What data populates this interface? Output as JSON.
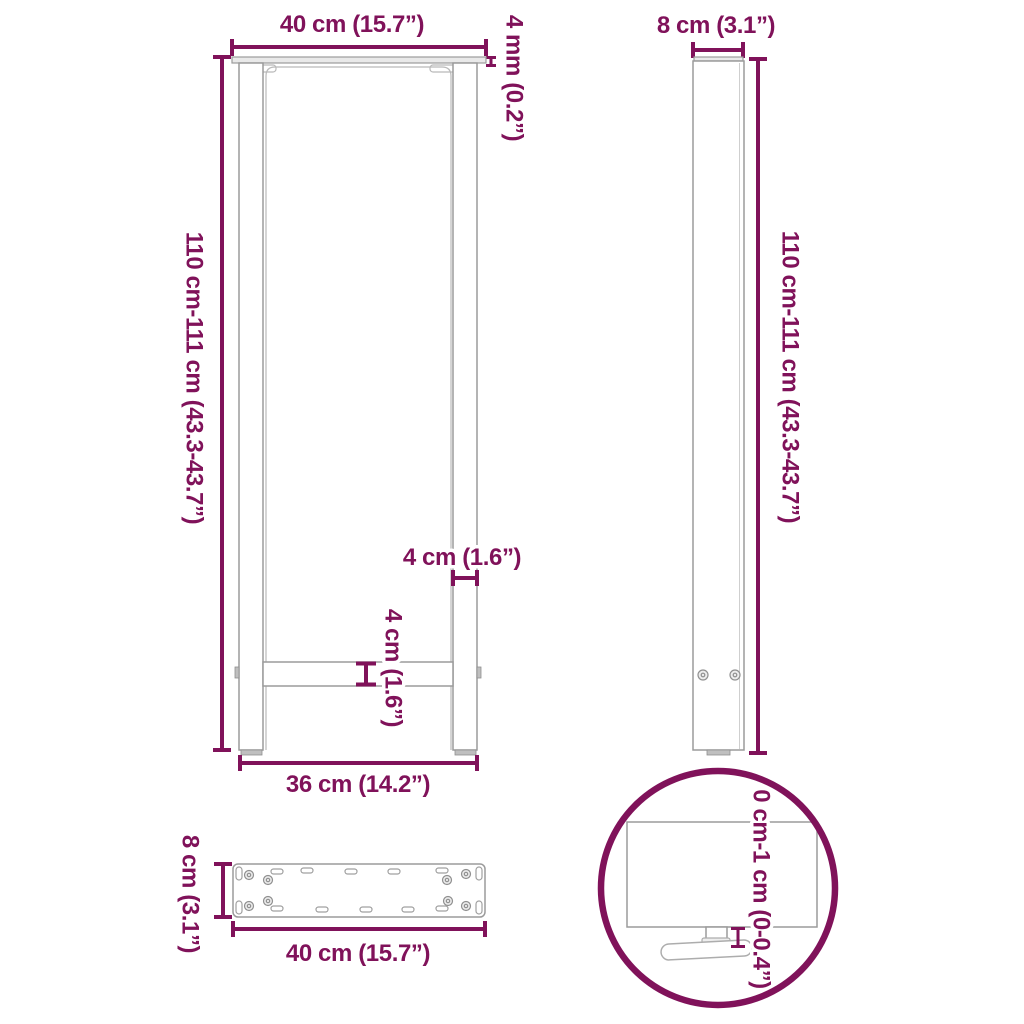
{
  "title": "Table leg dimension diagram",
  "colors": {
    "annotation": "#80125A",
    "outline": "#9b9b9b",
    "outline_light": "#b9b9b9",
    "fill_light": "#e9e9e9",
    "background": "#ffffff"
  },
  "front_view": {
    "top_width_label": "40 cm (15.7”)",
    "plate_thickness_label": "4 mm (0.2”)",
    "height_label": "110 cm-111 cm (43.3-43.7”)",
    "leg_width_label": "4 cm (1.6”)",
    "crossbar_thickness_label": "4 cm (1.6”)",
    "bottom_width_label": "36 cm (14.2”)"
  },
  "side_view": {
    "depth_label": "8 cm (3.1”)",
    "height_label": "110 cm-111 cm (43.3-43.7”)"
  },
  "top_view": {
    "depth_label": "8 cm (3.1”)",
    "width_label": "40 cm (15.7”)"
  },
  "detail_view": {
    "foot_adjust_label": "0 cm-1 cm (0-0.4”)"
  }
}
